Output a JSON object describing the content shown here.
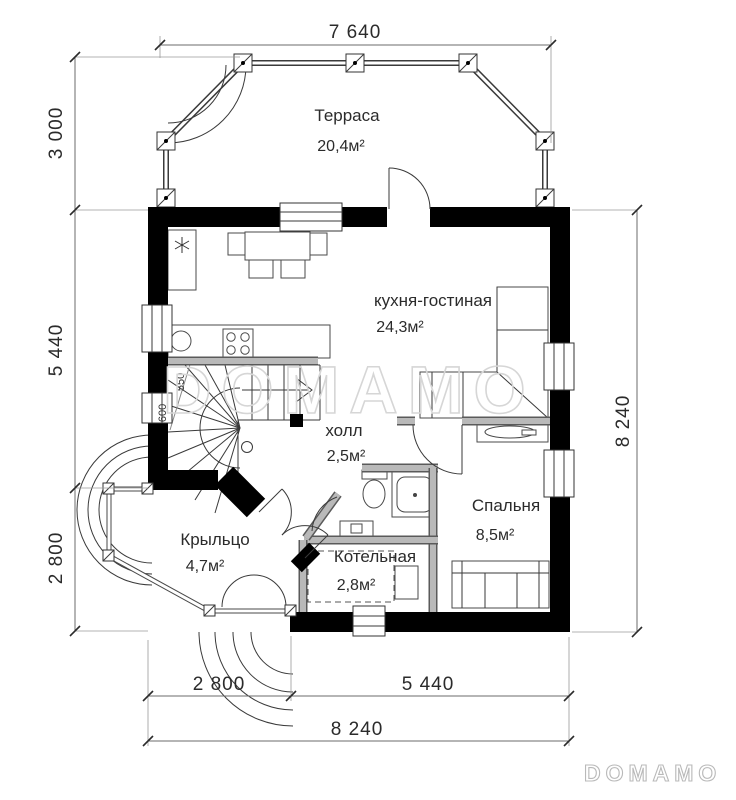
{
  "plan": {
    "title_note": "first floor plan drawing",
    "dimensions": {
      "top_width": "7 640",
      "left_terrace": "3 000",
      "left_main": "5 440",
      "left_porch": "2 800",
      "right_total": "8 240",
      "bottom_porch": "2 800",
      "bottom_main": "5 440",
      "bottom_total": "8 240"
    },
    "rooms": [
      {
        "name": "Терраса",
        "area": "20,4м²"
      },
      {
        "name": "кухня-гостиная",
        "area": "24,3м²"
      },
      {
        "name": "холл",
        "area": "2,5м²"
      },
      {
        "name": "Спальня",
        "area": "8,5м²"
      },
      {
        "name": "Крыльцо",
        "area": "4,7м²"
      },
      {
        "name": "Котельная",
        "area": "2,8м²"
      }
    ],
    "stair": {
      "tread_depth_1": "600",
      "tread_depth_2": "550"
    },
    "watermark_text": "DOMAMO",
    "logo_text": "DOMAMO",
    "colors": {
      "wall": "#000000",
      "thin_line": "#3a3a3a",
      "gray_partition": "#b9b9b9",
      "watermark": "#d6d6d6",
      "logo": "#b9b9b9",
      "background": "#ffffff"
    }
  }
}
